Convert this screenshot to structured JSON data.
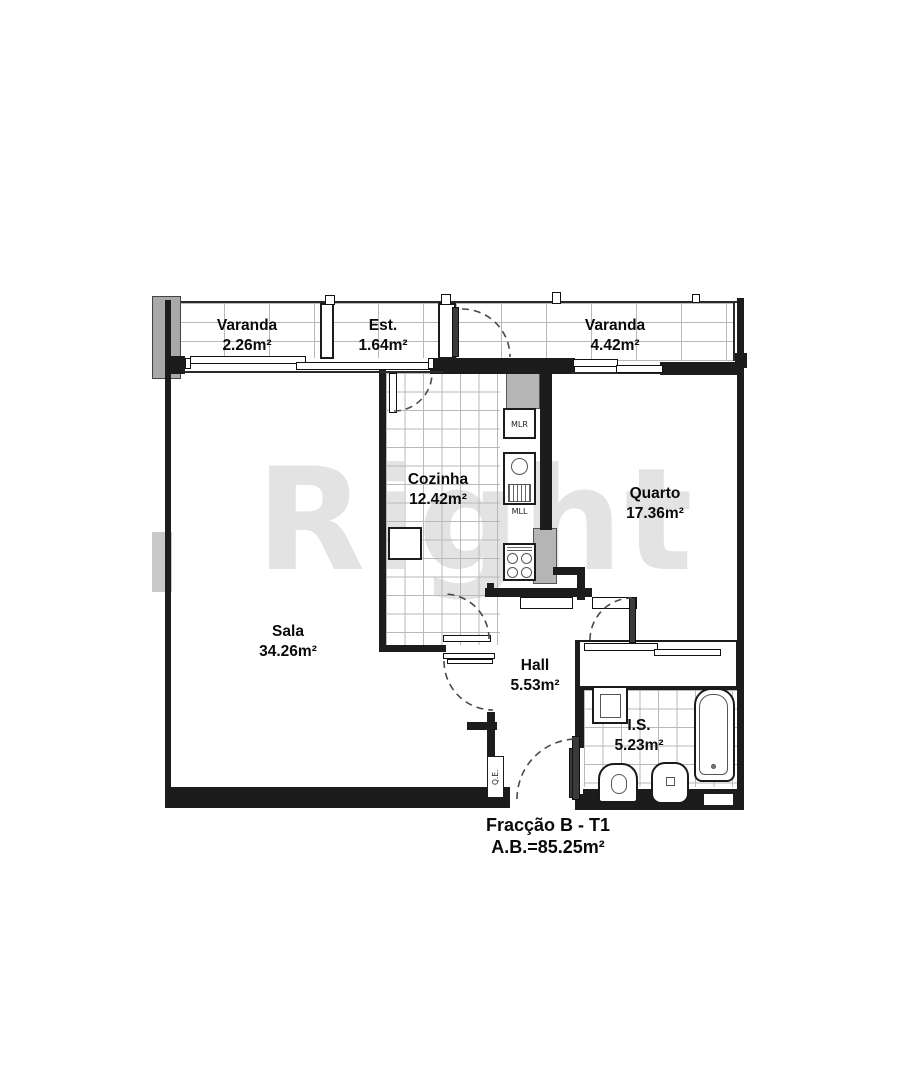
{
  "watermark": "Right",
  "rooms": {
    "varanda_left": {
      "name": "Varanda",
      "area": "2.26m²"
    },
    "est": {
      "name": "Est.",
      "area": "1.64m²"
    },
    "varanda_right": {
      "name": "Varanda",
      "area": "4.42m²"
    },
    "cozinha": {
      "name": "Cozinha",
      "area": "12.42m²"
    },
    "quarto": {
      "name": "Quarto",
      "area": "17.36m²"
    },
    "sala": {
      "name": "Sala",
      "area": "34.26m²"
    },
    "hall": {
      "name": "Hall",
      "area": "5.53m²"
    },
    "is": {
      "name": "I.S.",
      "area": "5.23m²"
    }
  },
  "appliance_labels": {
    "washing_machine": "MLR",
    "dishwasher": "MLL",
    "electrical_panel": "Q.E."
  },
  "footer": {
    "fraction": "Fracção B - T1",
    "gross_area": "A.B.=85.25m²"
  },
  "colors": {
    "wall": "#1c1c1c",
    "tile_line": "#b9b9b9",
    "pillar_grey": "#b3b3b3",
    "watermark_grey": "#e3e3e3"
  }
}
